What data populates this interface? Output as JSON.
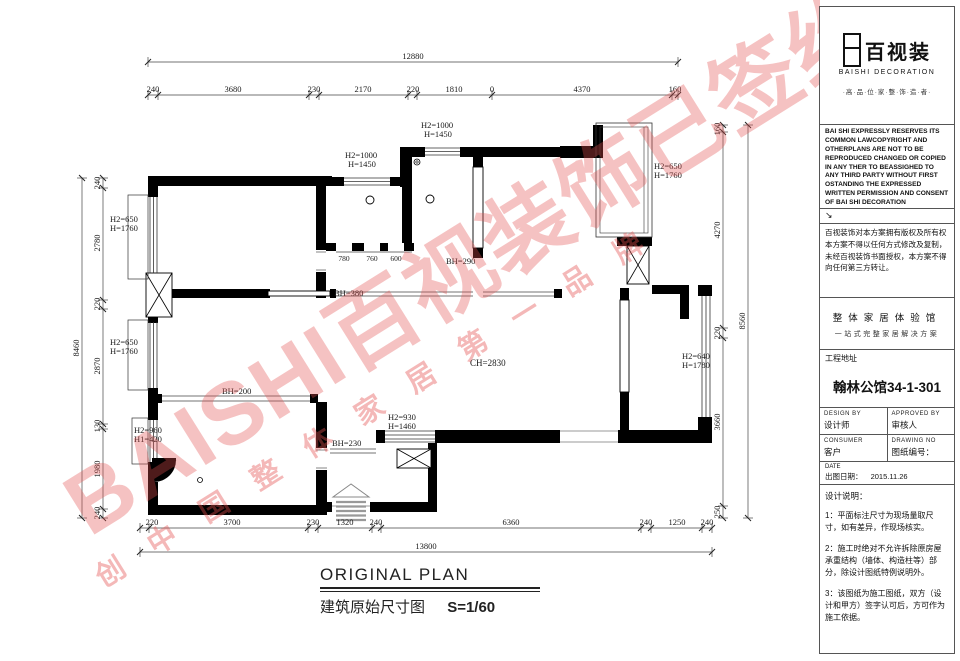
{
  "watermark": {
    "main": "BAISHI百视装饰已签约",
    "slogan": "创 中 国 整 体 家 居 第 一 品 牌"
  },
  "plan": {
    "title_en": "ORIGINAL PLAN",
    "title_cn": "建筑原始尺寸图",
    "scale": "S=1/60",
    "ceiling": "CH=2830",
    "totals": {
      "top": "12880",
      "bottom": "13800",
      "left": "8460",
      "right": "8560"
    },
    "top_segments": [
      "240",
      "3680",
      "230",
      "2170",
      "220",
      "1810",
      "0",
      "4370",
      "160"
    ],
    "bottom_segments": [
      "220",
      "3700",
      "230",
      "1320",
      "240",
      "6360",
      "240",
      "1250",
      "240"
    ],
    "left_segments": [
      "240",
      "2780",
      "220",
      "2870",
      "130",
      "1980",
      "240"
    ],
    "right_segments": [
      "160",
      "4270",
      "220",
      "3660",
      "250"
    ],
    "interior_dims": [
      "780",
      "760",
      "600"
    ],
    "windows": [
      {
        "a": "H2=650",
        "b": "H=1760"
      },
      {
        "a": "H2=650",
        "b": "H=1760"
      },
      {
        "a": "H2=960",
        "b": "H1=420"
      },
      {
        "a": "H2=1000",
        "b": "H=1450"
      },
      {
        "a": "H2=1000",
        "b": "H=1450"
      },
      {
        "a": "H2=650",
        "b": "H=1760"
      },
      {
        "a": "H2=640",
        "b": "H=1780"
      },
      {
        "a": "H2=930",
        "b": "H=1460"
      }
    ],
    "beams": {
      "bh380": "BH=380",
      "bh290": "BH=290",
      "bh200": "BH=200",
      "bh230": "BH=230"
    }
  },
  "tb": {
    "brand": "百视装",
    "brand_en": "BAISHI  DECORATION",
    "tagline": "·高·品·位·家·整·饰·造·者·",
    "copyright_en": "BAI SHI EXPRESSLY RESERVES ITS COMMON LAWCOPYRIGHT AND OTHERPLANS ARE NOT TO BE REPRODUCED CHANGED OR COPIED IN ANY THER TO BEASSIGHED TO ANY THIRD PARTY WITHOUT FIRST OSTANDING THE EXPRESSED WRITTEN PERMISSION AND CONSENT OF BAI SHI DECORATION",
    "corner_arrow": "↘",
    "copyright_cn": "百视装饰对本方案拥有版权及所有权本方案不得以任何方式修改及复制，未经百视装饰书面授权，本方案不得向任何第三方转让。",
    "exp1": "整体家居体验馆",
    "exp2": "一站式完整家居解决方案",
    "addr_label": "工程地址",
    "addr_value": "翰林公馆34-1-301",
    "design_en": "DESIGN BY",
    "design_cn": "设计师",
    "approved_en": "APPROVED BY",
    "approved_cn": "审核人",
    "consumer_en": "CONSUMER",
    "consumer_cn": "客户",
    "drawno_en": "DRAWING NO",
    "drawno_cn": "图纸编号：",
    "date_en": "DATE",
    "date_cn": "出图日期：",
    "date_value": "2015.11.26",
    "notes_title": "设计说明：",
    "notes": [
      "1：平面标注尺寸为现场量取尺寸，如有差异，作现场核实。",
      "2：施工时绝对不允许拆除原房屋承重结构（墙体、构造柱等）部分，除设计图纸特例说明外。",
      "3：该图纸为施工图纸，双方（设计和甲方）签字认可后，方可作为施工依据。"
    ]
  }
}
